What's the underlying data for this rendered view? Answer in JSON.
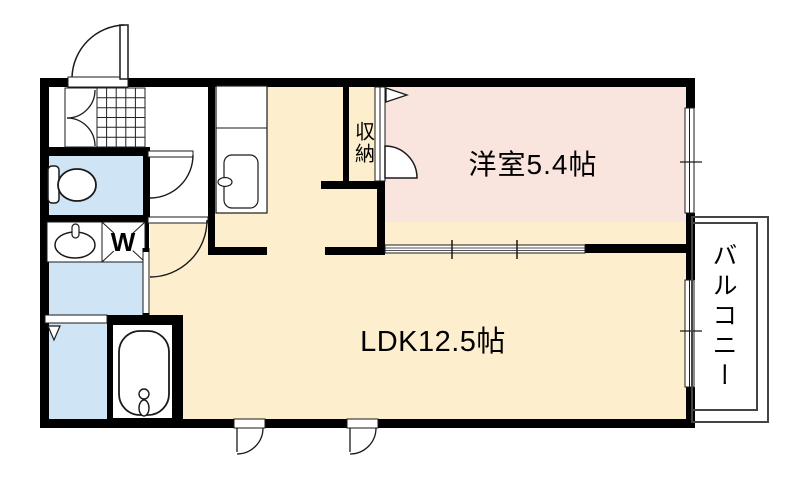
{
  "floorplan": {
    "title": "apartment-floor-plan",
    "rooms": {
      "western_room": {
        "label": "洋室5.4帖"
      },
      "ldk": {
        "label": "LDK12.5帖"
      },
      "storage": {
        "label": "収納"
      },
      "balcony": {
        "label": "バルコニー"
      },
      "washer_space": {
        "label": "W"
      }
    },
    "colors": {
      "western_room_fill": "#fae4de",
      "ldk_fill": "#fdeecd",
      "wet_area_fill": "#cfe4f4",
      "wall": "#000000",
      "balcony_line": "#444444"
    }
  }
}
